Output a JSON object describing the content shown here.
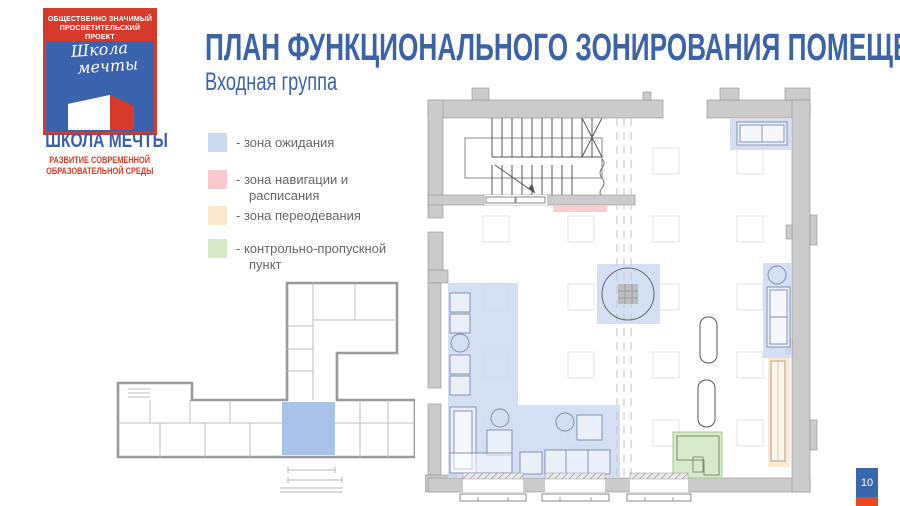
{
  "slide": {
    "title": "ПЛАН ФУНКЦИОНАЛЬНОГО ЗОНИРОВАНИЯ ПОМЕЩЕНИЯ",
    "subtitle": "Входная группа",
    "page_number": "10"
  },
  "logo": {
    "banner_line1": "ОБЩЕСТВЕННО ЗНАЧИМЫЙ",
    "banner_line2": "ПРОСВЕТИТЕЛЬСКИЙ ПРОЕКТ",
    "script_line1": "Школа",
    "script_line2": "мечты",
    "name": "ШКОЛА МЕЧТЫ",
    "tagline_line1": "РАЗВИТИЕ СОВРЕМЕННОЙ",
    "tagline_line2": "ОБРАЗОВАТЕЛЬНОЙ СРЕДЫ"
  },
  "legend": {
    "items": [
      {
        "line1": "- зона ожидания",
        "line2": "",
        "color": "#ccd9f2"
      },
      {
        "line1": "- зона навигации и",
        "line2": "расписания",
        "color": "#f9c9cd"
      },
      {
        "line1": "- зона переодевания",
        "line2": "",
        "color": "#fbe9cd"
      },
      {
        "line1": "- контрольно-пропускной",
        "line2": "пункт",
        "color": "#d7e8c9"
      }
    ]
  },
  "key_plan": {
    "highlight_color": "#a9c2e8"
  },
  "colors": {
    "title_blue": "#3c63a8",
    "logo_red": "#d63a2a",
    "logo_blue": "#3b62ac",
    "legend_text": "#666666",
    "wall_gray": "#cbcbcb",
    "badge_blue": "#3a66ad",
    "badge_red": "#e8491f"
  }
}
